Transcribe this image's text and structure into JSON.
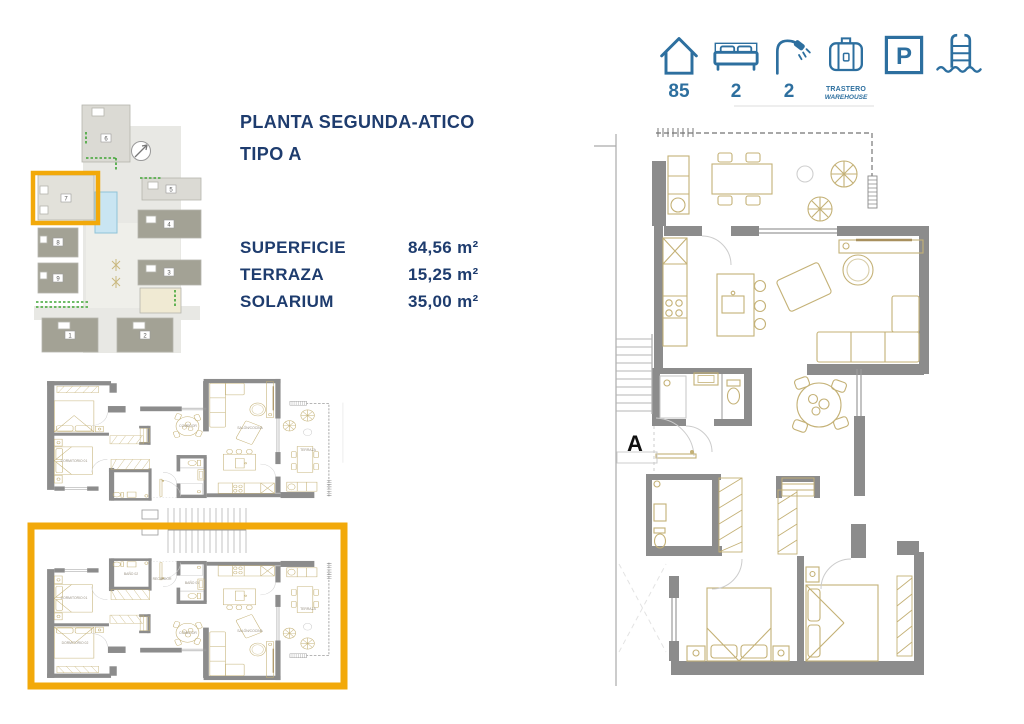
{
  "page": {
    "title_line1": "PLANTA SEGUNDA-ATICO",
    "title_line2": "TIPO A"
  },
  "amenity_bar": {
    "house": {
      "icon": "house-icon",
      "value": "85"
    },
    "bedrooms": {
      "icon": "bed-icon",
      "value": "2"
    },
    "bathrooms": {
      "icon": "shower-icon",
      "value": "2"
    },
    "storage": {
      "icon": "storage-icon",
      "label_line1": "TRASTERO",
      "label_line2": "WAREHOUSE"
    },
    "parking": {
      "icon": "parking-icon",
      "letter": "P"
    },
    "pool": {
      "icon": "pool-icon"
    }
  },
  "measurements": {
    "rows": [
      {
        "label": "SUPERFICIE",
        "value": "84,56 m²"
      },
      {
        "label": "TERRAZA",
        "value": "15,25 m²"
      },
      {
        "label": "SOLARIUM",
        "value": "35,00 m²"
      }
    ]
  },
  "site_plan": {
    "buildings": [
      "1",
      "2",
      "3",
      "4",
      "5",
      "6",
      "7",
      "8",
      "9"
    ],
    "highlighted_building": "7"
  },
  "building_plan": {
    "room_labels": {
      "bedroom1": "DORMITORIO 01",
      "bedroom2": "DORMITORIO 02",
      "bath1": "BAÑO 01",
      "bath2": "BAÑO 02",
      "hall": "RECIBIDOR",
      "dining": "COMEDOR",
      "living": "SALÓN/COCINA",
      "terrace": "TERRAZA"
    }
  },
  "main_plan": {
    "label": "A"
  },
  "colors": {
    "accent_blue": "#2D6F9F",
    "navy": "#1E3C6E",
    "highlight_orange": "#F2A90A"
  }
}
